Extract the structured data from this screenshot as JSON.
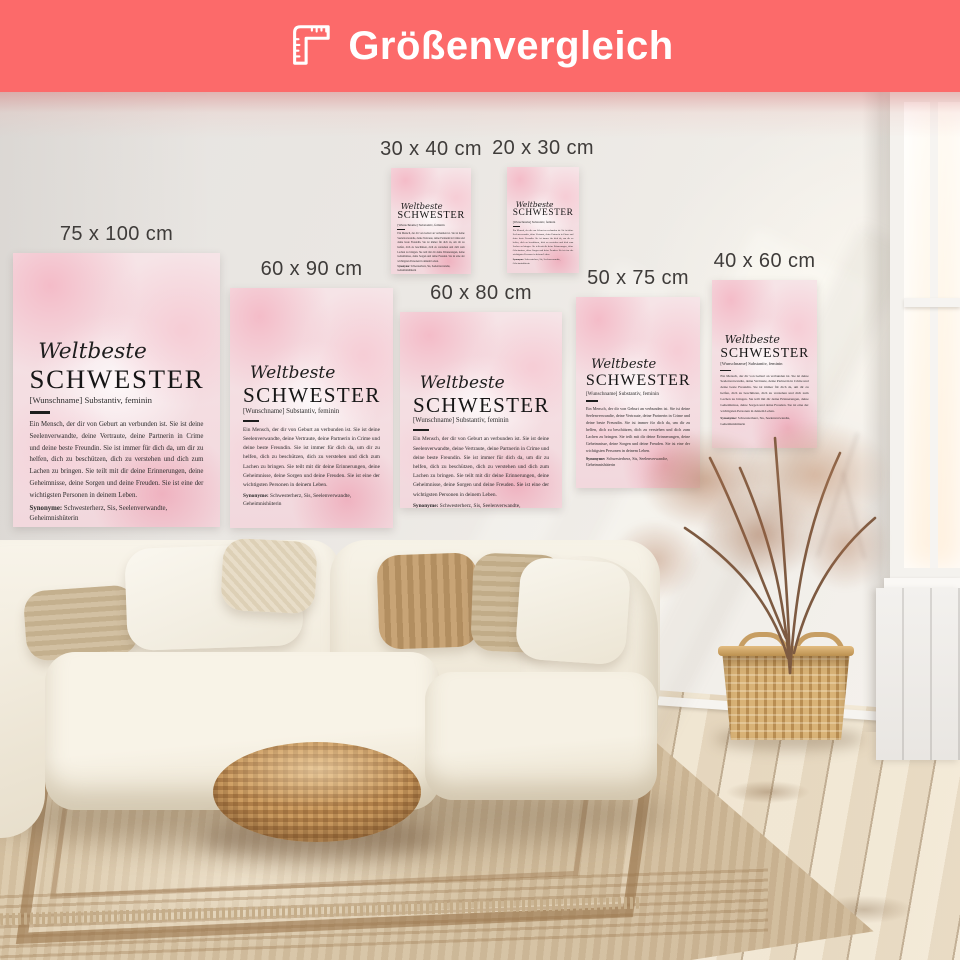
{
  "header": {
    "title": "Größenvergleich",
    "icon": "folding-ruler-icon",
    "bar_color": "#FC6A6A",
    "text_color": "#FFFFFF"
  },
  "poster": {
    "script_title": "Weltbeste",
    "main_title": "SCHWESTER",
    "subtitle": "[Wunschname] Substantiv, feminin",
    "body": "Ein Mensch, der dir von Geburt an verbunden ist. Sie ist deine Seelenverwandte, deine Vertraute, deine Partnerin in Crime und deine beste Freundin. Sie ist immer für dich da, um dir zu helfen, dich zu beschützen, dich zu verstehen und dich zum Lachen zu bringen. Sie teilt mit dir deine Erinnerungen, deine Geheimnisse, deine Sorgen und deine Freuden. Sie ist eine der wichtigsten Personen in deinem Leben.",
    "synonyms_label": "Synonyme:",
    "synonyms_text": "Schwesterherz, Sis, Seelenverwandte, Geheimnishüterin"
  },
  "sizes": [
    {
      "label": "75 x 100 cm"
    },
    {
      "label": "60 x 90 cm"
    },
    {
      "label": "30 x 40 cm"
    },
    {
      "label": "20 x 30 cm"
    },
    {
      "label": "60 x 80 cm"
    },
    {
      "label": "50 x 75 cm"
    },
    {
      "label": "40 x 60 cm"
    }
  ]
}
